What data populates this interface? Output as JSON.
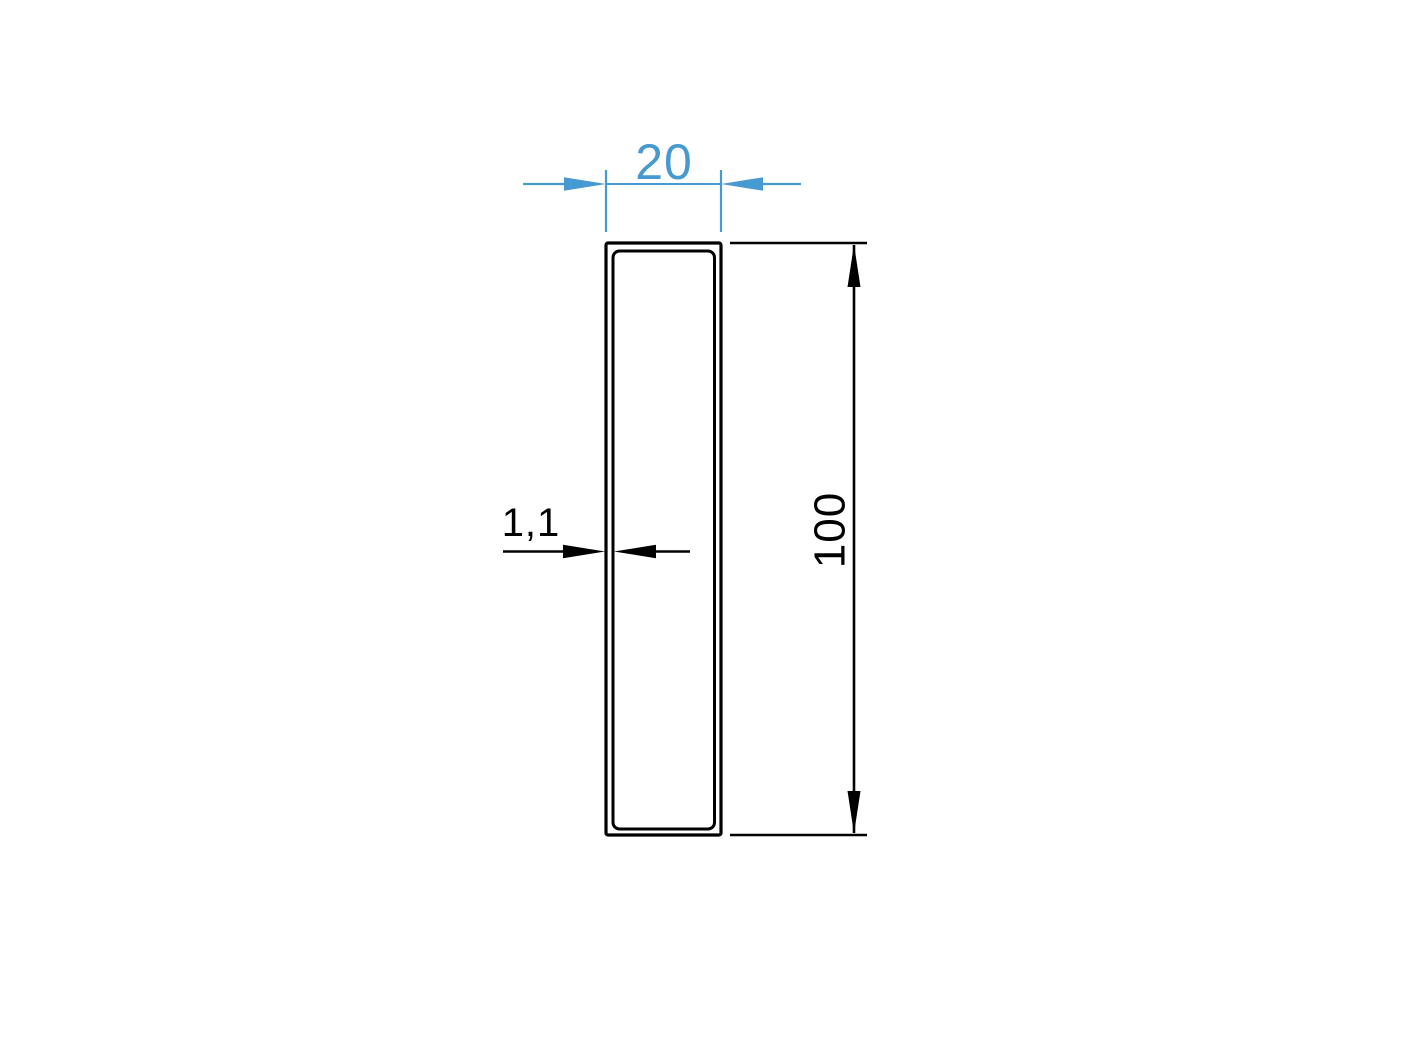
{
  "drawing": {
    "kind": "technical-drawing-profile-cross-section",
    "background_color": "#ffffff",
    "profile_line_color": "#000000",
    "accent_color": "#4699d1",
    "dimensions": {
      "width": {
        "label": "20",
        "color": "#4699d1"
      },
      "height": {
        "label": "100",
        "color": "#000000"
      },
      "wall_thickness": {
        "label": "1,1",
        "color": "#000000"
      }
    }
  }
}
